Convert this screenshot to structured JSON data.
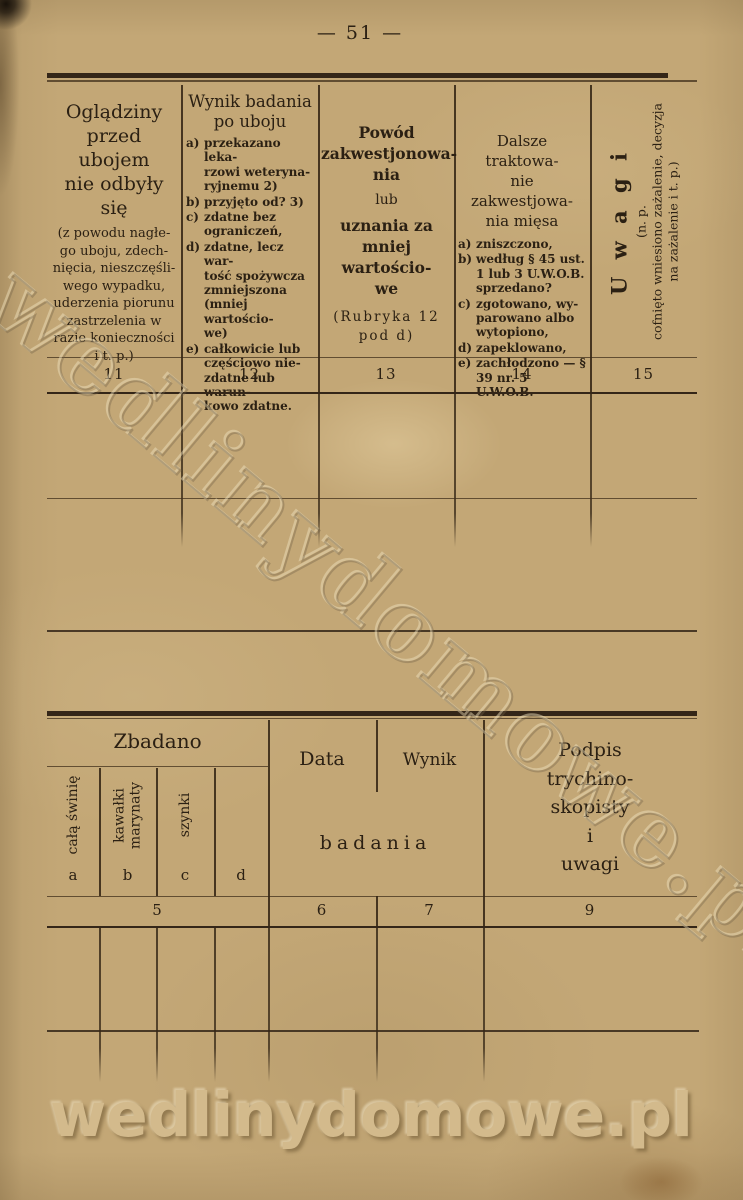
{
  "page": {
    "number_display": "— 51 —"
  },
  "watermarks": {
    "diagonal": "wedlinydomowe.pl",
    "bottom": "wedlinydomowe.pl"
  },
  "table1": {
    "columns": [
      {
        "number": "11",
        "title_lines": [
          "Oglądziny",
          "przed ubojem",
          "nie odbyły się"
        ],
        "note_lines": [
          "(z powodu nagłe-",
          "go uboju, zdech-",
          "nięcia, nieszczęśli-",
          "wego wypadku,",
          "uderzenia piorunu",
          "zastrzelenia w",
          "razie konieczności",
          "i t. p.)"
        ]
      },
      {
        "number": "12",
        "title_lines": [
          "Wynik badania",
          "po uboju"
        ],
        "items": [
          {
            "key": "a)",
            "lines": [
              "przekazano leka-",
              "rzowi weteryna-",
              "ryjnemu 2)"
            ]
          },
          {
            "key": "b)",
            "lines": [
              "przyjęto od? 3)"
            ]
          },
          {
            "key": "c)",
            "lines": [
              "zdatne bez",
              "ograniczeń,"
            ]
          },
          {
            "key": "d)",
            "lines": [
              "zdatne, lecz war-",
              "tość spożywcza",
              "zmniejszona",
              "(mniej wartościo-",
              "we)"
            ]
          },
          {
            "key": "e)",
            "lines": [
              "całkowicie lub",
              "częściowo nie-",
              "zdatne lub warun-",
              "kowo zdatne."
            ]
          }
        ]
      },
      {
        "number": "13",
        "bold_top_lines": [
          "Powód",
          "zakwestjonowa-",
          "nia"
        ],
        "connector": "lub",
        "bold_bottom_lines": [
          "uznania za",
          "mniej wartościo-",
          "we"
        ],
        "note_lines": [
          "(Rubryka 12",
          "pod d)"
        ]
      },
      {
        "number": "14",
        "title_lines": [
          "Dalsze traktowa-",
          "nie zakwestjowa-",
          "nia mięsa"
        ],
        "items": [
          {
            "key": "a)",
            "lines": [
              "zniszczono,"
            ]
          },
          {
            "key": "b)",
            "lines": [
              "według § 45 ust.",
              "1 lub 3 U.W.O.B.",
              "sprzedano?"
            ]
          },
          {
            "key": "c)",
            "lines": [
              "zgotowano, wy-",
              "parowano albo",
              "wytopiono,"
            ]
          },
          {
            "key": "d)",
            "lines": [
              "zapeklowano,"
            ]
          },
          {
            "key": "e)",
            "lines": [
              "zachłodzono — §",
              "39 nr. 5 U.W.O.B."
            ]
          }
        ]
      },
      {
        "number": "15",
        "rotated_title": "U w a g i",
        "rotated_note_lines": [
          "(n. p.",
          "cofnięto wniesiono zażalenie, decyzja",
          "na zażalenie i t. p.)"
        ]
      }
    ]
  },
  "table2": {
    "group_label": "Zbadano",
    "subcolumns": [
      {
        "letter": "a",
        "label_lines": [
          "całą świnię"
        ]
      },
      {
        "letter": "b",
        "label_lines": [
          "kawałki",
          "marynaty"
        ]
      },
      {
        "letter": "c",
        "label_lines": [
          "szynki"
        ]
      },
      {
        "letter": "d",
        "label_lines": []
      }
    ],
    "date_label": "Data",
    "result_label": "Wynik",
    "span_label": "badania",
    "signature_lines": [
      "Podpis",
      "trychino-",
      "skopisty",
      "i",
      "uwagi"
    ],
    "column_numbers": [
      "5",
      "6",
      "7",
      "9"
    ]
  }
}
